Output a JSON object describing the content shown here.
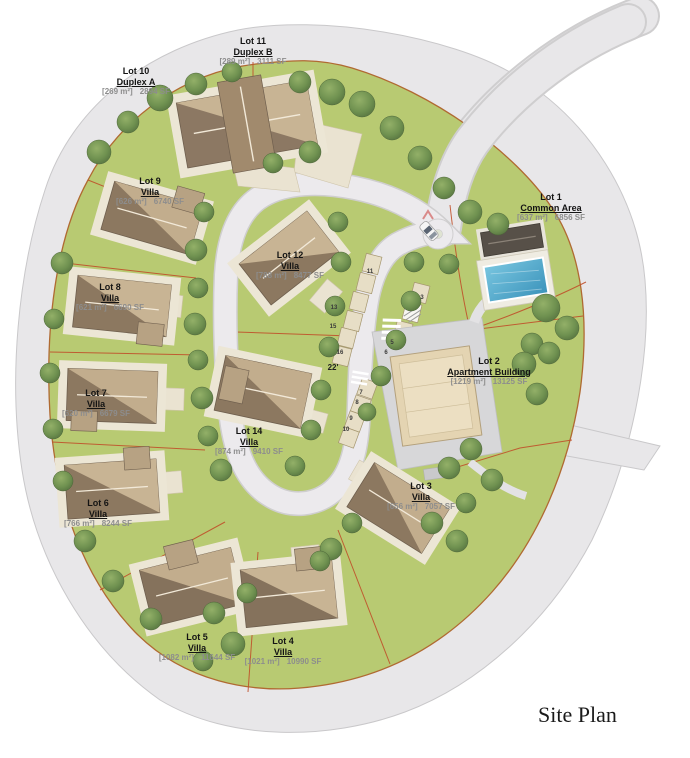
{
  "title": "Site Plan",
  "road_width_label": "22'",
  "colors": {
    "site_green": "#b8ca72",
    "road_gray": "#e8e7e9",
    "road_edge": "#c9c8ca",
    "lot_line": "#c0502a",
    "boundary_line": "#b06a32",
    "roof_dark": "#8c7860",
    "roof_light": "#c8b494",
    "pool_blue": "#4aa5cc",
    "tree_green": "#6f9150",
    "label_gray": "#8d8d8d"
  },
  "lots": [
    {
      "lot": "Lot 1",
      "name": "Common Area",
      "area_m2": "[637 m²]",
      "area_sf": "6856 SF"
    },
    {
      "lot": "Lot 2",
      "name": "Apartment Building",
      "area_m2": "[1219 m²]",
      "area_sf": "13125 SF"
    },
    {
      "lot": "Lot 3",
      "name": "Villa",
      "area_m2": "[656 m²]",
      "area_sf": "7057 SF"
    },
    {
      "lot": "Lot 4",
      "name": "Villa",
      "area_m2": "[1021 m²]",
      "area_sf": "10990 SF"
    },
    {
      "lot": "Lot 5",
      "name": "Villa",
      "area_m2": "[1082 m²]",
      "area_sf": "11644 SF"
    },
    {
      "lot": "Lot 6",
      "name": "Villa",
      "area_m2": "[766 m²]",
      "area_sf": "8244 SF"
    },
    {
      "lot": "Lot 7",
      "name": "Villa",
      "area_m2": "[620 m²]",
      "area_sf": "6679 SF"
    },
    {
      "lot": "Lot 8",
      "name": "Villa",
      "area_m2": "[621 m²]",
      "area_sf": "6690 SF"
    },
    {
      "lot": "Lot 9",
      "name": "Villa",
      "area_m2": "[626 m²]",
      "area_sf": "6740 SF"
    },
    {
      "lot": "Lot 10",
      "name": "Duplex A",
      "area_m2": "[269 m²]",
      "area_sf": "2894 SF"
    },
    {
      "lot": "Lot 11",
      "name": "Duplex B",
      "area_m2": "[289 m²]",
      "area_sf": "3111 SF"
    },
    {
      "lot": "Lot 12",
      "name": "Villa",
      "area_m2": "[788 m²]",
      "area_sf": "8477 SF"
    },
    {
      "lot": "Lot 14",
      "name": "Villa",
      "area_m2": "[874 m²]",
      "area_sf": "9410 SF"
    }
  ],
  "parking_stalls": [
    "3",
    "5",
    "6",
    "7",
    "8",
    "9",
    "10",
    "11",
    "13",
    "15",
    "16"
  ]
}
